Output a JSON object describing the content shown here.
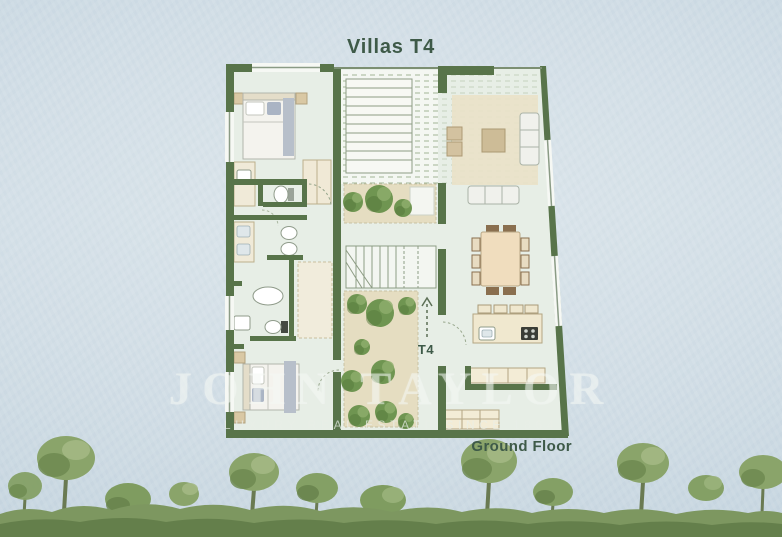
{
  "title": "Villas T4",
  "plan": {
    "unit_label": "T4",
    "floor_label": "Ground Floor"
  },
  "watermark": {
    "brand": "JOHN TAYLOR",
    "tagline": "LUXURY REAL ESTATE SINCE 1864"
  },
  "colors": {
    "sky_blue": "#cdd9e3",
    "wall_green": "#587349",
    "floor_light_green": "#e7eee6",
    "courtyard_beige": "#e5ddc1",
    "rug_beige": "#eae1c8",
    "tree_green": "#7d9c5e",
    "label_green": "#3e5a48",
    "watermark_white": "#f4f7f3"
  }
}
